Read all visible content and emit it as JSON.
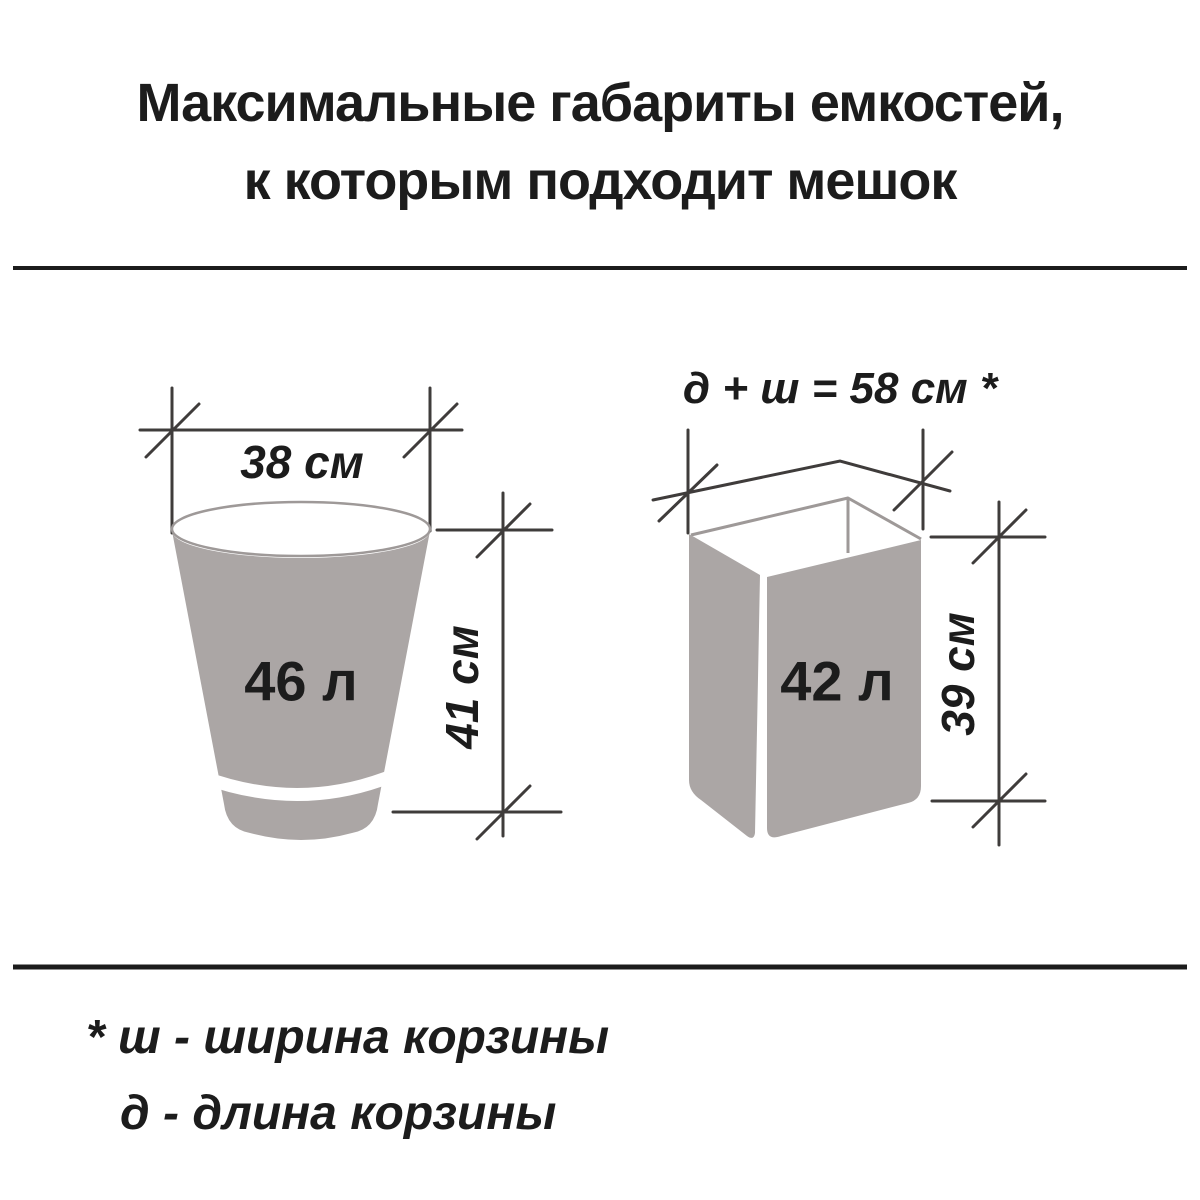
{
  "title": {
    "line1": "Максимальные габариты емкостей,",
    "line2": "к которым подходит мешок"
  },
  "bucket": {
    "width_label": "38 см",
    "volume_label": "46 л",
    "height_label": "41 см"
  },
  "bin": {
    "formula_label": "д + ш = 58 см *",
    "volume_label": "42 л",
    "height_label": "39 см"
  },
  "footnote": {
    "line1": "* ш - ширина корзины",
    "line2": "д - длина корзины"
  },
  "colors": {
    "container_fill": "#aba6a5",
    "rim_stroke": "#9e9998",
    "dim_line": "#3f3c3b",
    "divider": "#1c1c1c",
    "text": "#1c1c1c"
  }
}
